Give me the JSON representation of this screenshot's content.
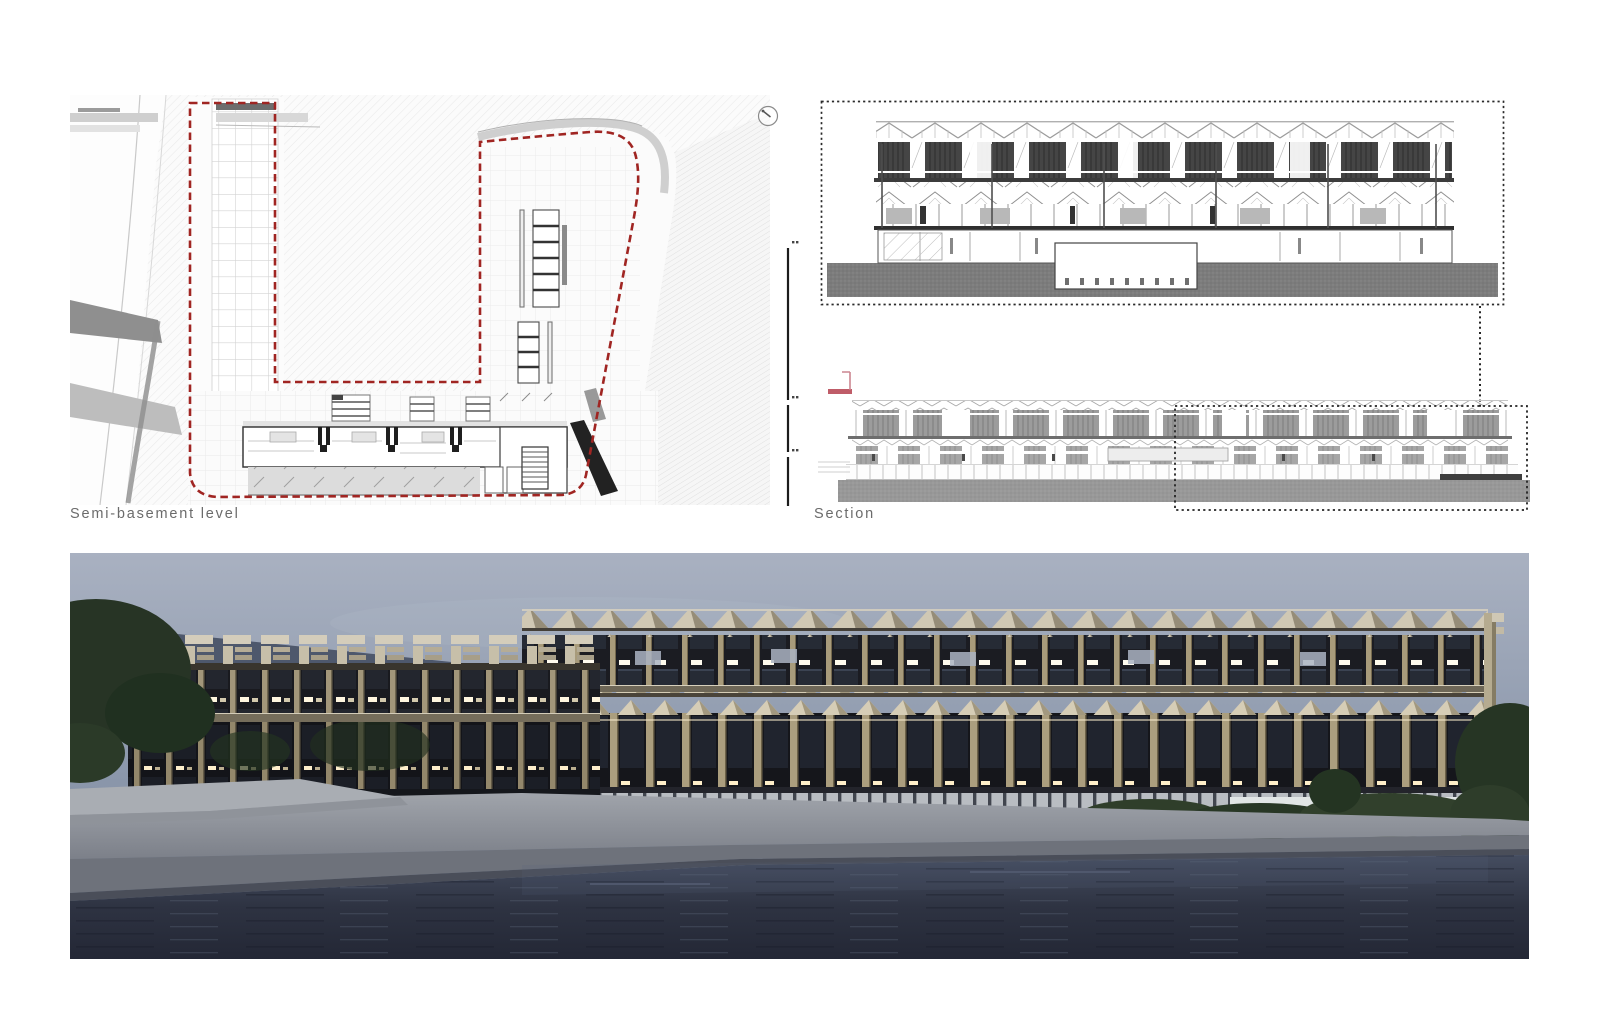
{
  "board": {
    "title_labels": {
      "plan": "Semi-basement level",
      "section": "Section"
    },
    "icons": {
      "north_arrow": "north-arrow-icon",
      "key_plan": "key-plan-icon",
      "scale_bar": "vertical-scale-bar"
    },
    "colors": {
      "site_boundary_red": "#a02522",
      "key_plan_red": "#b4404e",
      "dotted_frame_black": "#262626",
      "drawing_ground_gray": "#7c7c7c",
      "render_sky_blue_gray": "#8b97ab",
      "render_water_dark": "#2b303e",
      "render_timber_beige": "#cfc7b3",
      "render_quay_gray": "#8b8f97"
    },
    "figures": {
      "plan_drawing": "semi-basement-floor-plan",
      "upper_right_drawing": "building-cross-section",
      "lower_right_drawing": "building-elevation-with-detail-box",
      "bottom_image": "waterfront-building-render"
    }
  }
}
